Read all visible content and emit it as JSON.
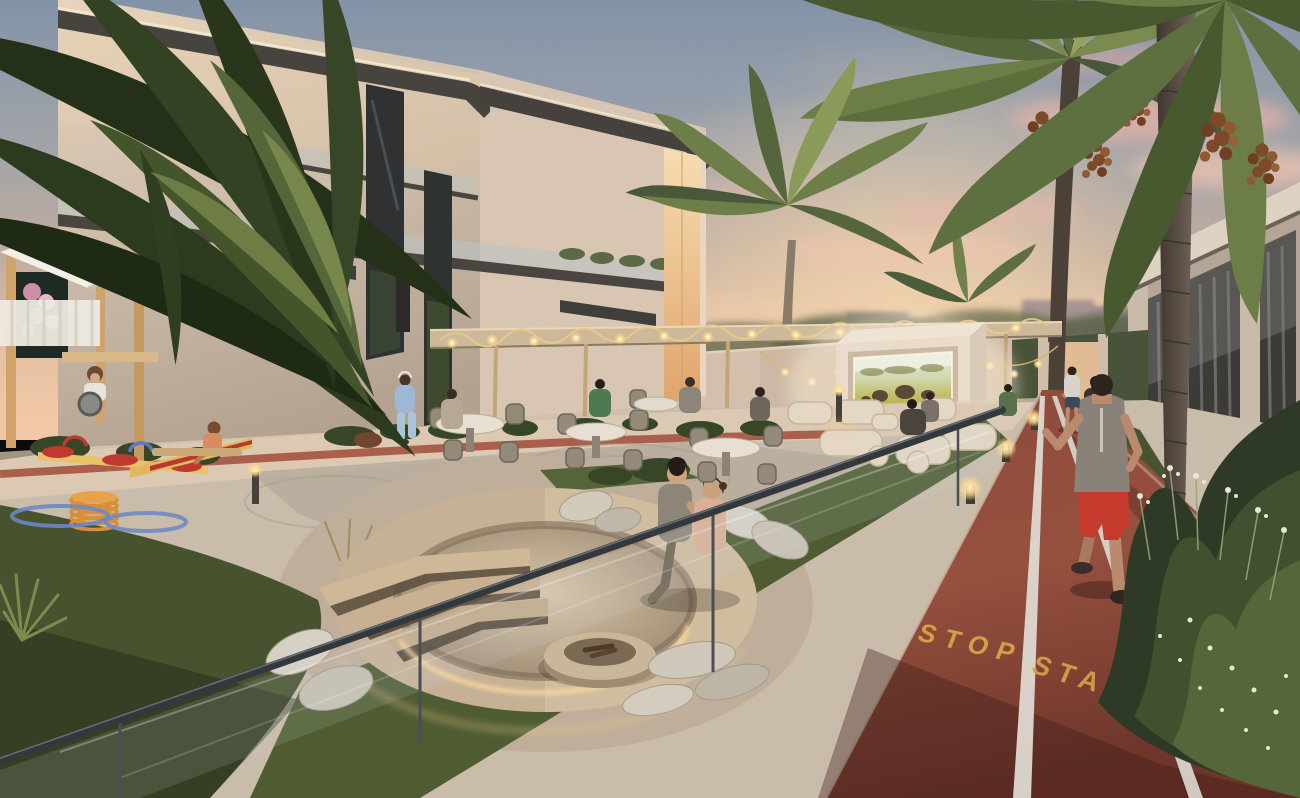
{
  "scene": {
    "track_markings": {
      "stop": "STOP",
      "start": "START"
    },
    "palette": {
      "sky_top": "#8293a8",
      "sunset_horizon": "#f0c8a5",
      "cloud_pink": "#e9b3a8",
      "building_facade": "#d8c6b2",
      "track_surface": "#8f4636",
      "track_marking": "#d9a648",
      "lane_line": "#ded9d2",
      "grass_dark": "#46532e",
      "palm_frond": "#49583a",
      "string_light_glow": "#ffd98f",
      "handrail": "#33383d",
      "cinema_screen_glow": "#f5efd0",
      "fire_pit_concrete": "#c6b197"
    }
  }
}
